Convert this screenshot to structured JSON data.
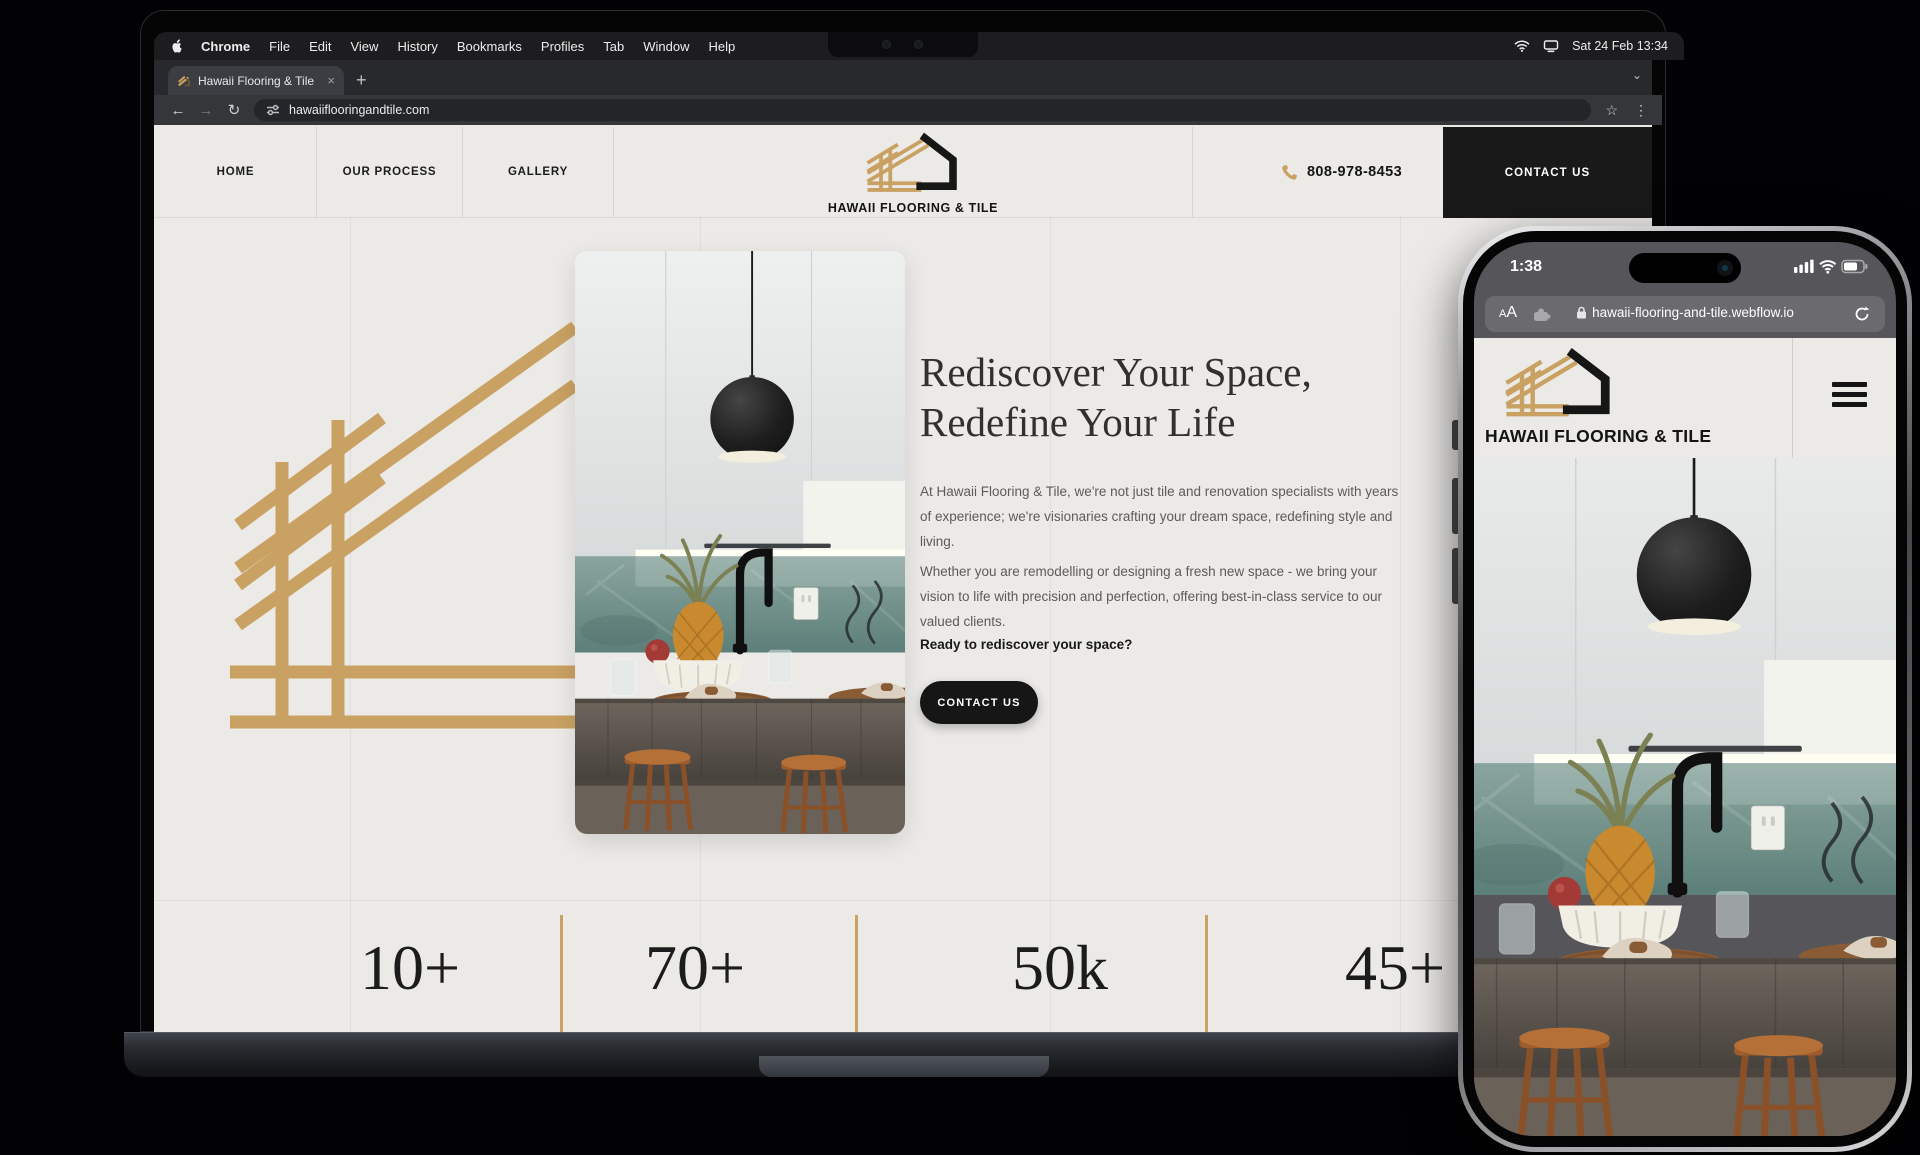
{
  "menubar": {
    "items": [
      "Chrome",
      "File",
      "Edit",
      "View",
      "History",
      "Bookmarks",
      "Profiles",
      "Tab",
      "Window",
      "Help"
    ],
    "status_date": "Sat 24 Feb 13:34"
  },
  "browser": {
    "tab_title": "Hawaii Flooring & Tile",
    "close_tab": "×",
    "new_tab": "+",
    "url": "hawaiiflooringandtile.com",
    "back": "←",
    "forward": "→",
    "reload": "↻",
    "star": "☆",
    "menu": "⋮",
    "chevron": "⌄"
  },
  "site": {
    "nav": {
      "links": [
        "HOME",
        "OUR PROCESS",
        "GALLERY"
      ],
      "brand": "HAWAII FLOORING & TILE",
      "phone": "808-978-8453",
      "contact": "CONTACT US"
    },
    "hero": {
      "heading_line1": "Rediscover Your Space,",
      "heading_line2": "Redefine Your Life",
      "para1": "At Hawaii Flooring & Tile, we're not just tile and renovation specialists with years of experience; we're visionaries crafting your dream space, redefining style and living.",
      "para2": "Whether you are remodelling or designing a fresh new space - we bring your vision to life with precision and perfection, offering best-in-class service to our valued clients.",
      "question": "Ready to rediscover your space?",
      "cta": "CONTACT US"
    },
    "stats": {
      "values": [
        "10+",
        "70+",
        "50k",
        "45+"
      ]
    }
  },
  "phone": {
    "time": "1:38",
    "aa": "AA",
    "url": "hawaii-flooring-and-tile.webflow.io",
    "brand": "HAWAII FLOORING & TILE"
  },
  "colors": {
    "gold": "#C9A162",
    "dark": "#191919",
    "site_bg": "#ECEAE7"
  }
}
